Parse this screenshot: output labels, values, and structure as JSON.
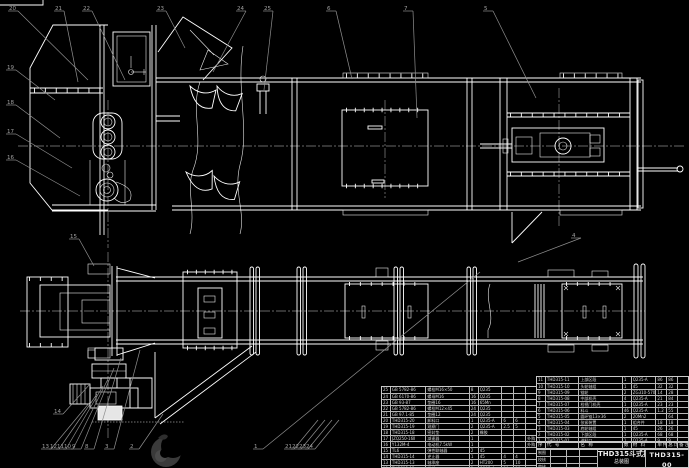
{
  "colors": {
    "background": "#000000",
    "line": "#ffffff",
    "leader": "#8f8f8f",
    "table_border": "#c9c9c9",
    "logo": "#3a3a3a"
  },
  "title_block": {
    "product_title_line1": "THD315斗式提升机",
    "product_title_line2": "总装图",
    "drawing_no": "THD315-00",
    "org_line": "机械设计制造及其自动化",
    "grid_rows": [
      [
        "制图",
        "",
        "",
        ""
      ],
      [
        "校核",
        "",
        "",
        ""
      ],
      [
        "审核",
        "",
        "",
        ""
      ]
    ]
  },
  "bom_header": {
    "rows": [
      [
        "序",
        "代  号",
        "名  称",
        "数",
        "材  料",
        "单件",
        "总计",
        "备注"
      ]
    ]
  },
  "bom_right": {
    "rows": [
      [
        "11",
        "THD315-11",
        "上部区段",
        "1",
        "Q235-A",
        "86",
        "86",
        ""
      ],
      [
        "10",
        "THD315-10",
        "头轮轴组",
        "1",
        "45",
        "32",
        "32",
        ""
      ],
      [
        "9",
        "THD315-09",
        "链轮",
        "2",
        "ZG310-570",
        "14",
        "28",
        ""
      ],
      [
        "8",
        "THD315-08",
        "中部机壳",
        "4",
        "Q235-A",
        "21",
        "84",
        ""
      ],
      [
        "7",
        "THD315-07",
        "检视门机壳",
        "1",
        "Q235-A",
        "23",
        "23",
        ""
      ],
      [
        "6",
        "THD315-06",
        "料斗",
        "46",
        "Q235-A",
        "1.2",
        "55",
        ""
      ],
      [
        "5",
        "THD315-05",
        "圆环链13×36",
        "2",
        "20Mn2",
        "",
        "64",
        ""
      ],
      [
        "4",
        "THD315-04",
        "张紧装置",
        "1",
        "组合件",
        "18",
        "18",
        ""
      ],
      [
        "3",
        "THD315-03",
        "底轮轴组",
        "1",
        "45",
        "26",
        "26",
        ""
      ],
      [
        "2",
        "THD315-02",
        "下部区段",
        "1",
        "Q235-A",
        "68",
        "68",
        ""
      ],
      [
        "1",
        "THD315-01",
        "进料口",
        "1",
        "Q235-A",
        "9",
        "9",
        ""
      ]
    ]
  },
  "bom_left": {
    "rows": [
      [
        "25",
        "GB 5782-86",
        "螺栓M16×50",
        "8",
        "Q235",
        "",
        "",
        ""
      ],
      [
        "24",
        "GB 6170-86",
        "螺母M16",
        "16",
        "Q235",
        "",
        "",
        ""
      ],
      [
        "23",
        "GB 93-87",
        "垫圈16",
        "16",
        "65Mn",
        "",
        "",
        ""
      ],
      [
        "22",
        "GB 5782-86",
        "螺栓M12×45",
        "24",
        "Q235",
        "",
        "",
        ""
      ],
      [
        "21",
        "GB 97.1-85",
        "垫圈12",
        "24",
        "Q235",
        "",
        "",
        ""
      ],
      [
        "20",
        "THD315-20",
        "卸料口",
        "1",
        "Q235-A",
        "6",
        "6",
        ""
      ],
      [
        "19",
        "THD315-19",
        "观察门",
        "2",
        "Q235-A",
        "2.5",
        "5",
        ""
      ],
      [
        "18",
        "THD315-18",
        "密封垫",
        "2",
        "橡胶",
        "",
        "",
        ""
      ],
      [
        "17",
        "JZQ250-16Ⅱ",
        "减速器",
        "1",
        "",
        "",
        "",
        "外购"
      ],
      [
        "16",
        "Y132M-4",
        "电动机7.5kW",
        "1",
        "",
        "",
        "",
        "外购"
      ],
      [
        "15",
        "TL6",
        "弹性联轴器",
        "2",
        "45",
        "",
        "",
        ""
      ],
      [
        "14",
        "THD315-14",
        "逆止器",
        "1",
        "45",
        "4",
        "4",
        ""
      ],
      [
        "13",
        "THD315-13",
        "轴承座",
        "2",
        "HT200",
        "5",
        "10",
        ""
      ],
      [
        "12",
        "THD315-12",
        "机架",
        "1",
        "Q235-A",
        "30",
        "30",
        ""
      ]
    ]
  },
  "callouts": [
    {
      "n": "20",
      "x": 12,
      "y": 9,
      "ex": 88,
      "ey": 80
    },
    {
      "n": "21",
      "x": 58,
      "y": 9,
      "ex": 78,
      "ey": 82
    },
    {
      "n": "22",
      "x": 86,
      "y": 9,
      "ex": 125,
      "ey": 80
    },
    {
      "n": "23",
      "x": 160,
      "y": 9,
      "ex": 185,
      "ey": 48
    },
    {
      "n": "24",
      "x": 240,
      "y": 9,
      "ex": 213,
      "ey": 72
    },
    {
      "n": "25",
      "x": 267,
      "y": 9,
      "ex": 264,
      "ey": 90
    },
    {
      "n": "6",
      "x": 330,
      "y": 9,
      "ex": 352,
      "ey": 79
    },
    {
      "n": "7",
      "x": 407,
      "y": 9,
      "ex": 417,
      "ey": 118
    },
    {
      "n": "5",
      "x": 487,
      "y": 9,
      "ex": 536,
      "ey": 98
    },
    {
      "n": "19",
      "x": 10,
      "y": 68,
      "ex": 55,
      "ey": 100
    },
    {
      "n": "18",
      "x": 10,
      "y": 103,
      "ex": 60,
      "ey": 138
    },
    {
      "n": "17",
      "x": 10,
      "y": 132,
      "ex": 72,
      "ey": 168
    },
    {
      "n": "16",
      "x": 10,
      "y": 158,
      "ex": 80,
      "ey": 196
    },
    {
      "n": "15",
      "x": 73,
      "y": 237,
      "ex": 94,
      "ey": 266
    },
    {
      "n": "4",
      "x": 575,
      "y": 236,
      "ex": 518,
      "ey": 262
    },
    {
      "n": "14",
      "x": 57,
      "y": 412,
      "ex": 90,
      "ey": 384
    },
    {
      "n": "13",
      "x": 45,
      "y": 447,
      "ex": 90,
      "ey": 402
    },
    {
      "n": "12",
      "x": 53,
      "y": 447,
      "ex": 97,
      "ey": 394
    },
    {
      "n": "11",
      "x": 60,
      "y": 447,
      "ex": 103,
      "ey": 386
    },
    {
      "n": "10",
      "x": 67,
      "y": 447,
      "ex": 109,
      "ey": 377
    },
    {
      "n": "9",
      "x": 75,
      "y": 447,
      "ex": 114,
      "ey": 368
    },
    {
      "n": "8",
      "x": 88,
      "y": 447,
      "ex": 121,
      "ey": 358
    },
    {
      "n": "3",
      "x": 108,
      "y": 447,
      "ex": 140,
      "ey": 350
    },
    {
      "n": "2",
      "x": 133,
      "y": 447,
      "ex": 163,
      "ey": 414
    },
    {
      "n": "1",
      "x": 257,
      "y": 447,
      "ex": 480,
      "ey": 272
    },
    {
      "n": "21",
      "x": 288,
      "y": 447,
      "ex": 318,
      "ey": 420
    },
    {
      "n": "22",
      "x": 295,
      "y": 447,
      "ex": 325,
      "ey": 420
    },
    {
      "n": "23",
      "x": 302,
      "y": 447,
      "ex": 332,
      "ey": 420
    },
    {
      "n": "24",
      "x": 309,
      "y": 447,
      "ex": 339,
      "ey": 420
    }
  ],
  "logo": {
    "name": "crescent-watermark"
  }
}
